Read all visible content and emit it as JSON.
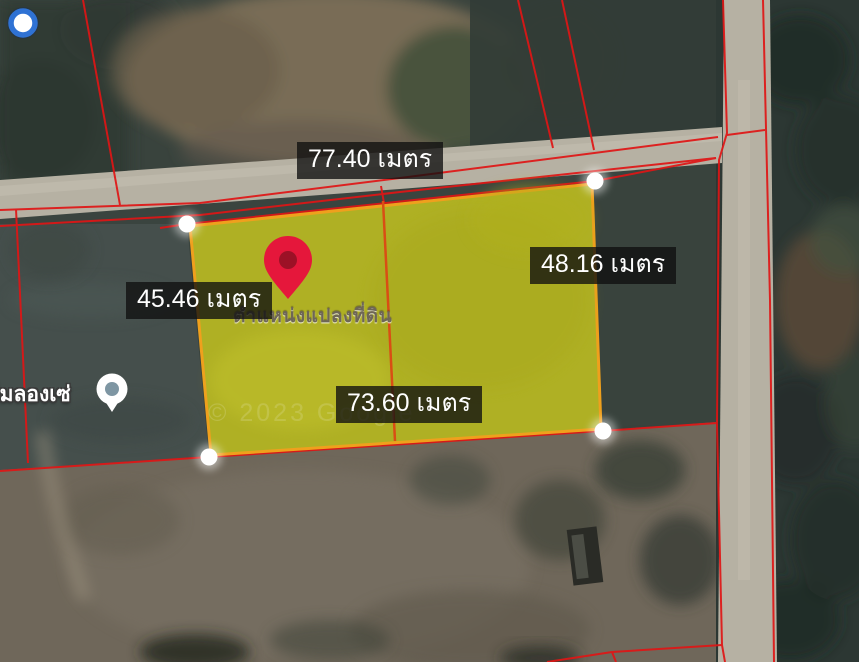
{
  "map": {
    "description": "Satellite cadastral map with highlighted land parcel",
    "measurements": {
      "top": "77.40 เมตร",
      "left": "45.46 เมตร",
      "right": "48.16 เมตร",
      "bottom": "73.60 เมตร"
    },
    "labels": {
      "pin_caption": "ตำแหน่งแปลงที่ดิน",
      "place_name": "ดื่มลองเซ่",
      "watermark": "© 2023 Google"
    },
    "icons": {
      "pin": "red-location-pin",
      "place": "white-circle-poi",
      "blue_dot": "blue-ring-dot",
      "vertex": "white-vertex-dot"
    },
    "colors": {
      "parcel_fill": "#bcbc21",
      "parcel_border": "#efa01d",
      "boundary_red": "#e01515",
      "divider_orange": "#d94e14",
      "pin_red": "#e5173b",
      "pin_hole": "#9c1126",
      "accent_blue": "#2f72d4",
      "road_gray": "#b6b1a3"
    }
  }
}
